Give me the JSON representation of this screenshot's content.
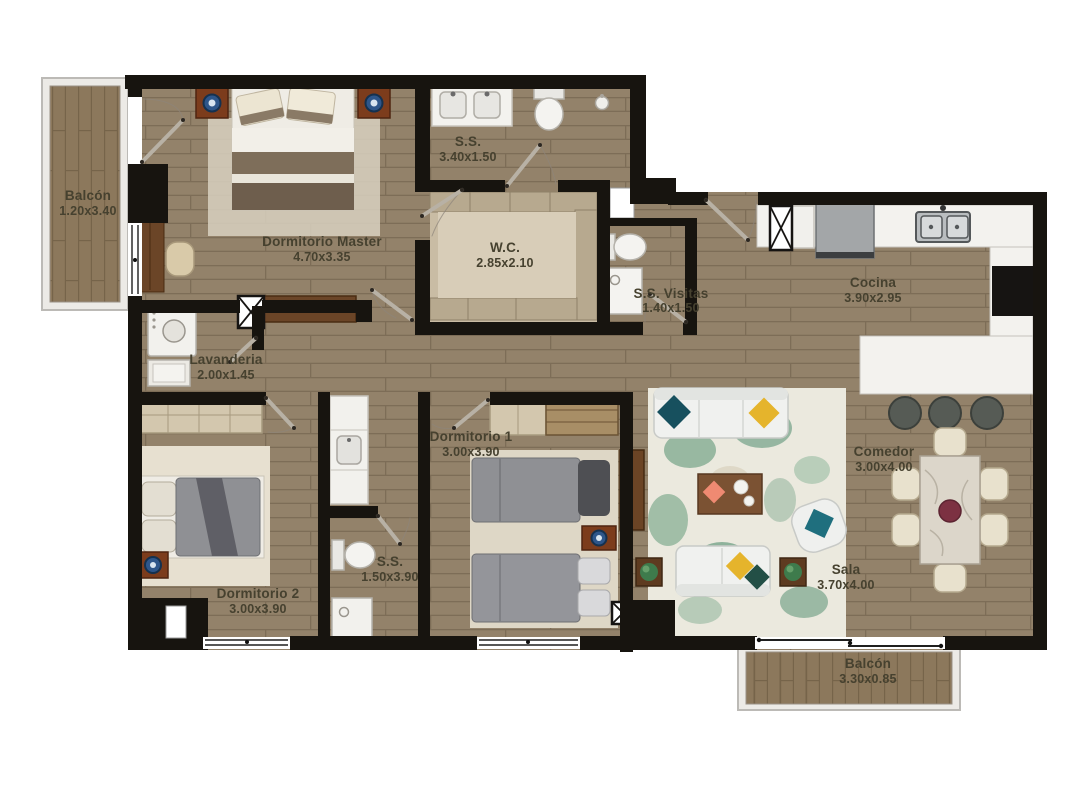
{
  "document": {
    "type": "apartment-floor-plan"
  },
  "rooms": [
    {
      "id": "balcon-superior",
      "name": "Balcón",
      "dims": "1.20x3.40"
    },
    {
      "id": "dormitorio-master",
      "name": "Dormitorio Master",
      "dims": "4.70x3.35"
    },
    {
      "id": "ss-master",
      "name": "S.S.",
      "dims": "3.40x1.50"
    },
    {
      "id": "wc",
      "name": "W.C.",
      "dims": "2.85x2.10"
    },
    {
      "id": "ss-visitas",
      "name": "S.S. Visitas",
      "dims": "1.40x1.50"
    },
    {
      "id": "cocina",
      "name": "Cocina",
      "dims": "3.90x2.95"
    },
    {
      "id": "lavanderia",
      "name": "Lavanderia",
      "dims": "2.00x1.45"
    },
    {
      "id": "dormitorio-2",
      "name": "Dormitorio 2",
      "dims": "3.00x3.90"
    },
    {
      "id": "ss-medio",
      "name": "S.S.",
      "dims": "1.50x3.90"
    },
    {
      "id": "dormitorio-1",
      "name": "Dormitorio 1",
      "dims": "3.00x3.90"
    },
    {
      "id": "sala",
      "name": "Sala",
      "dims": "3.70x4.00"
    },
    {
      "id": "comedor",
      "name": "Comedor",
      "dims": "3.00x4.00"
    },
    {
      "id": "balcon-inferior",
      "name": "Balcón",
      "dims": "3.30x0.85"
    }
  ],
  "colors": {
    "wall": "#17140f",
    "wood_floor": "#93826a",
    "balcony_wood": "#8c785c",
    "fixture_white": "#f3f2ee",
    "closet_tan": "#d3c7ae",
    "accent_teal": "#1f6f7e",
    "accent_yellow": "#e5b42c",
    "accent_coral": "#ef8a72",
    "lamp_blue": "#2e568a",
    "rug_green": "#84ac92"
  }
}
